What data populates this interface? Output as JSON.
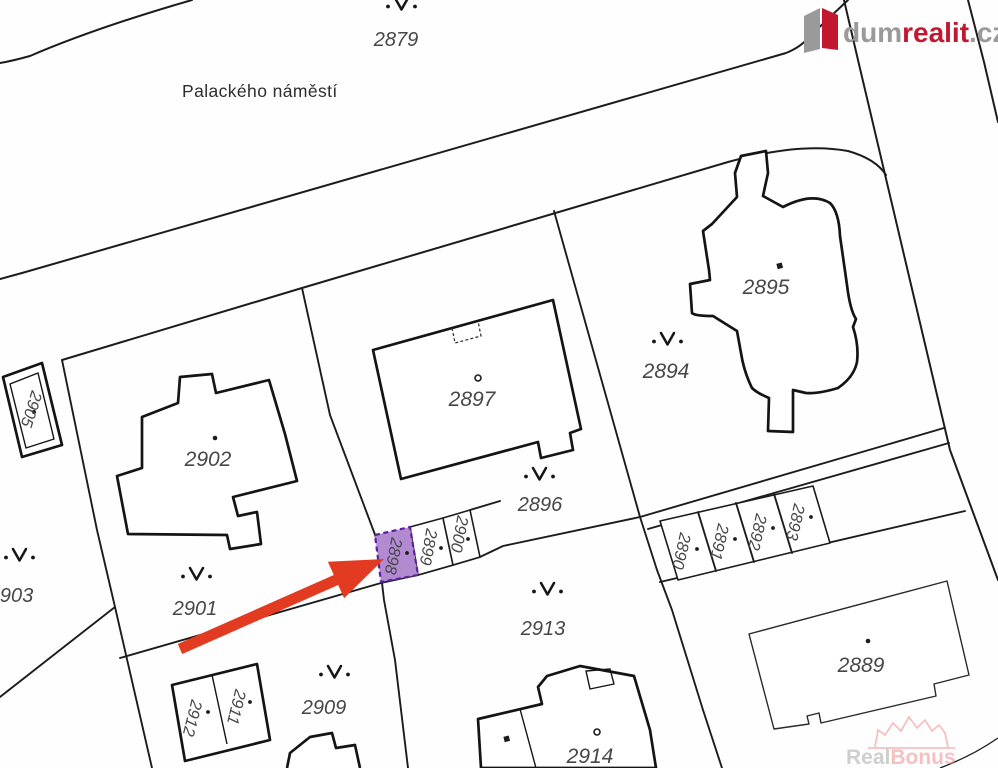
{
  "map": {
    "street_label": "Palackého náměstí",
    "highlighted_parcel": "2898",
    "parcels": {
      "p2879": "2879",
      "p2889": "2889",
      "p2890": "2890",
      "p2891": "2891",
      "p2892": "2892",
      "p2893": "2893",
      "p2894": "2894",
      "p2895": "2895",
      "p2896": "2896",
      "p2897": "2897",
      "p2898": "2898",
      "p2899": "2899",
      "p2900": "2900",
      "p2901": "2901",
      "p2902": "2902",
      "p2903": "2903",
      "p2905": "2905",
      "p2909": "2909",
      "p2911": "2911",
      "p2912": "2912",
      "p2913": "2913",
      "p2914": "2914"
    },
    "colors": {
      "highlight_fill": "#b18ad2",
      "highlight_stroke": "#5e1f9e",
      "arrow": "#e23b21",
      "line": "#1c1c1c"
    }
  },
  "logo": {
    "dum": "dum",
    "realit": "realit",
    "cz": ".cz",
    "colors": {
      "gray": "#9a9a9a",
      "red": "#c2182f"
    }
  },
  "watermark": {
    "real": "Real",
    "bonus": "Bonus",
    "colors": {
      "gray": "#a8a8a8",
      "pink": "#ee8f8f"
    }
  }
}
